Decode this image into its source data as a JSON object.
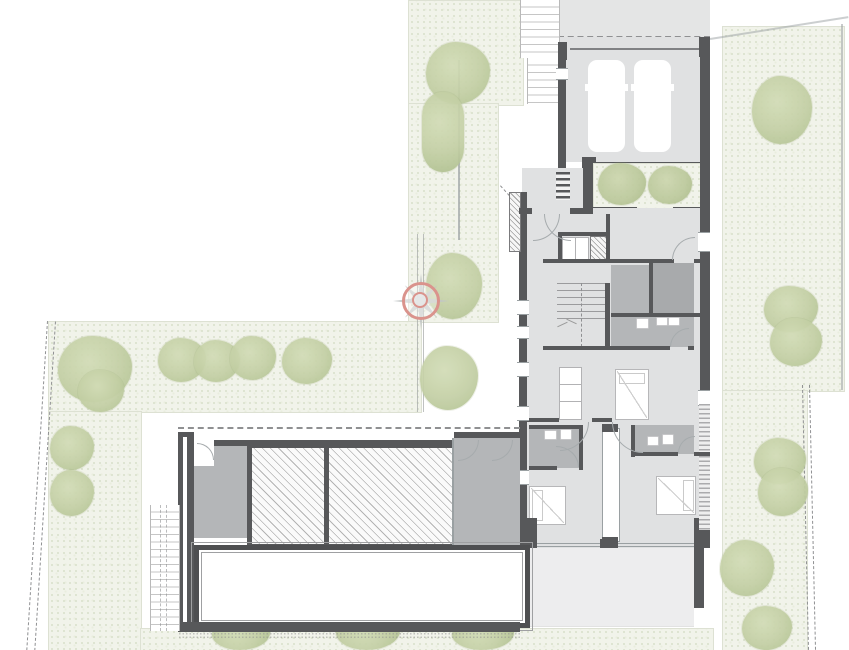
{
  "plan": {
    "type": "architectural-site-floor-plan",
    "features": {
      "site": "residential-site-plan",
      "driveway": "driveway",
      "garage": "double-garage",
      "car": "parked-car",
      "entry_steps": "entry-steps",
      "entry_court": "planted-entry-court",
      "house": "main-house",
      "hall": "entrance-hall",
      "wardrobe": "built-in-wardrobe",
      "stairs": "staircase",
      "bathroom": "bathroom",
      "bedroom": "bedroom",
      "bed": "double-bed",
      "terrace": "garden-terrace",
      "wing": "pool-wing",
      "skylight": "roof-glazing",
      "pool": "lap-pool",
      "garden_stair": "garden-stair",
      "lawn": "lawn",
      "tree": "tree",
      "hedge": "hedge",
      "boundary": "property-boundary",
      "compass": "north-symbol"
    }
  },
  "colors": {
    "paper": "#ffffff",
    "wall": "#57585a",
    "line": "#9aa0a2",
    "dash": "#8f9092",
    "floor_light": "#e0e1e2",
    "floor_mid": "#b4b6b8",
    "floor_dark": "#a8aaac",
    "drive": "#e4e5e5",
    "terrace": "#ededee",
    "grass": "#f1f3ea",
    "grass_dot": "#dde3d0",
    "tree_hi": "#d2dcb6",
    "tree_lo": "#c3cfa4",
    "tree_dk": "#aebf8e",
    "pool_edge": "#4e4f51",
    "compass": "#da938c"
  }
}
